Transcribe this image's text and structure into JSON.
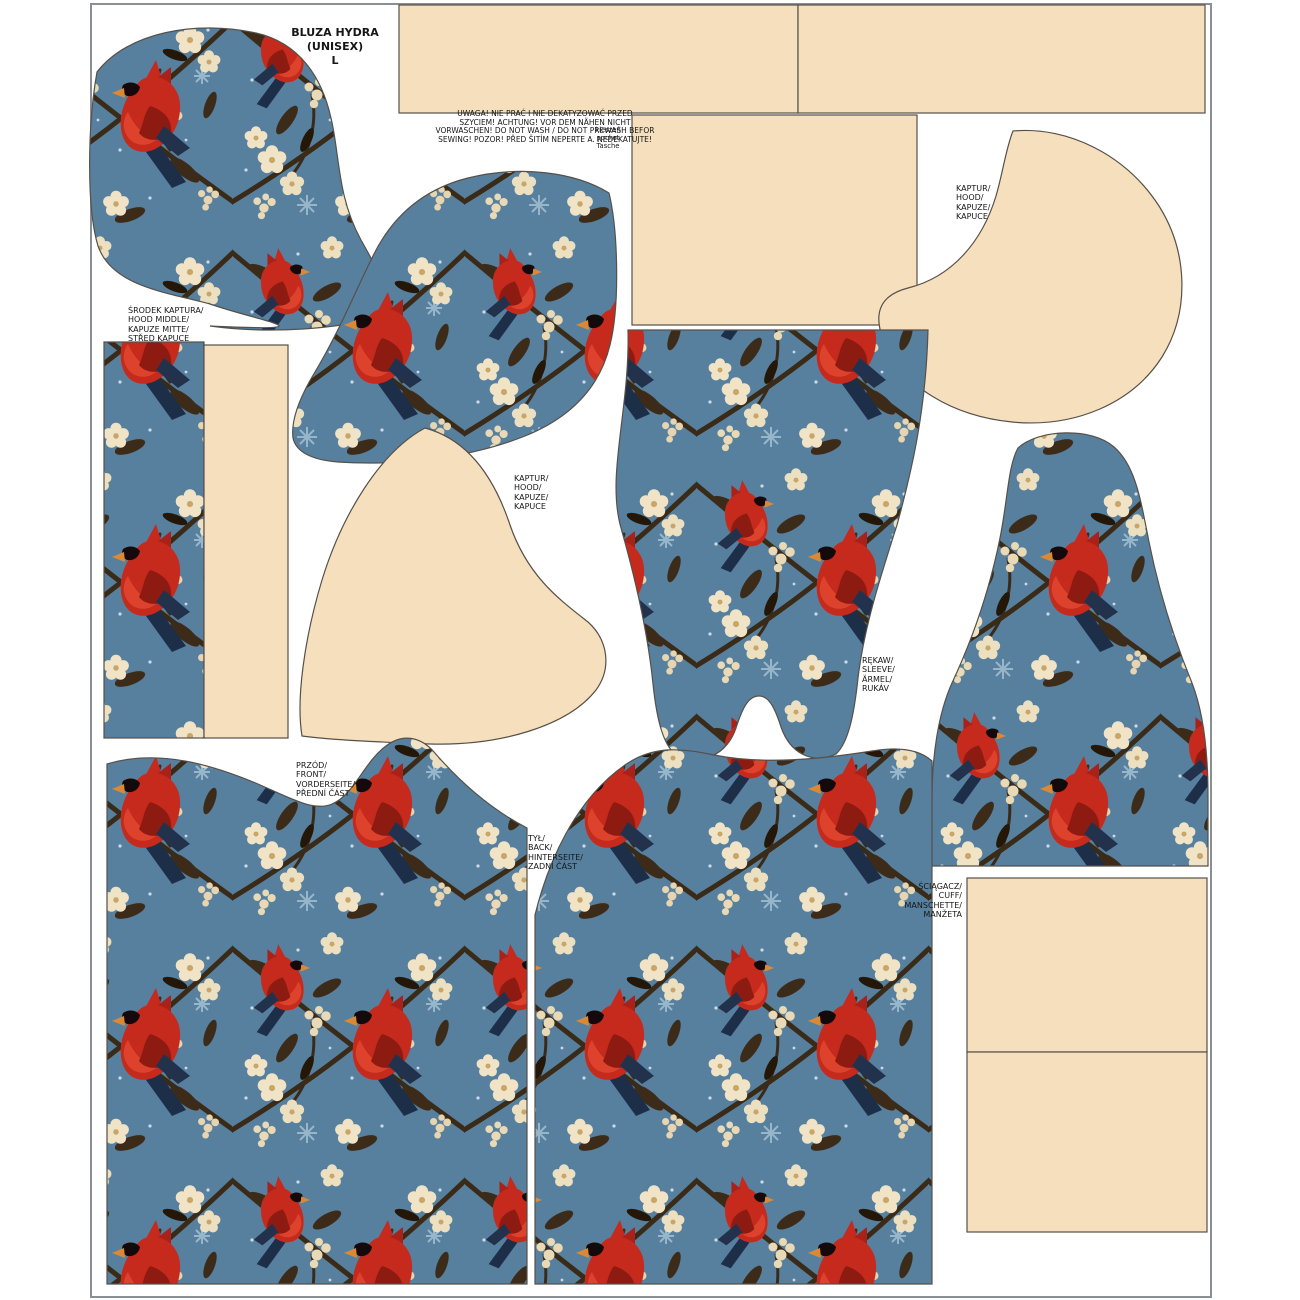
{
  "sheet": {
    "product": {
      "title": "BLUZA HYDRA\n(UNISEX)\nL"
    },
    "warning": "UWAGA! NIE PRAĆ I NIE DEKATYZOWAĆ PRZED\nSZYCIEM! ACHTUNG! VOR DEM NÄHEN NICHT\nVORWASCHEN! DO NOT WASH / DO NOT PREWASH  BEFOR\nSEWING! POZOR! PŘED ŠITÍM NEPERTE A. NEDEKATUJTE!",
    "pocket_note": "kieszeń\npocket\nTasche",
    "labels": {
      "hood_middle": "ŚRODEK KAPTURA/\nHOOD MIDDLE/\nKAPUZE MITTE/\nSTŘED KAPUCE",
      "hood_center": "KAPTUR/\nHOOD/\nKAPUZE/\nKAPUCE",
      "hood_right": "KAPTUR/\nHOOD/\nKAPUZE/\nKAPUCE",
      "sleeve": "RĘKAW/\nSLEEVE/\nÄRMEL/\nRUKÁV",
      "front": "PRZÓD/\nFRONT/\nVORDERSEITE/\nPŘEDNÍ ČÁST",
      "back": "TYŁ/\nBACK/\nHINTERSEITE/\nZADNÍ ČÁST",
      "cuff": "ŚCIĄGACZ/\nCUFF/\nMANSCHETTE/\nMANŽETA"
    },
    "colors": {
      "fabric_blue": "#57809f",
      "blank_beige": "#f6dfbc",
      "cardinal_red": "#c52a1d",
      "cardinal_dark_red": "#8e1b12",
      "blossom_cream": "#f0e3c6",
      "branch_brown": "#3a2a18",
      "wing_navy": "#1d2e49",
      "piece_outline": "#56504a",
      "sheet_border_gray": "#8a8f93"
    },
    "pieces": [
      {
        "name": "hood-piece-print-left",
        "fill": "print"
      },
      {
        "name": "hood-piece-print-center",
        "fill": "print"
      },
      {
        "name": "hood-piece-blank-center",
        "fill": "plain"
      },
      {
        "name": "hood-piece-blank-right",
        "fill": "plain"
      },
      {
        "name": "waistband-strip-left",
        "fill": "plain"
      },
      {
        "name": "waistband-strip-right",
        "fill": "plain"
      },
      {
        "name": "pocket-panel",
        "fill": "plain"
      },
      {
        "name": "hood-middle-strip-print",
        "fill": "print"
      },
      {
        "name": "hood-middle-strip-blank",
        "fill": "plain"
      },
      {
        "name": "sleeve-piece-print-center",
        "fill": "print"
      },
      {
        "name": "sleeve-piece-print-right",
        "fill": "print"
      },
      {
        "name": "front-piece",
        "fill": "print"
      },
      {
        "name": "back-piece",
        "fill": "print"
      },
      {
        "name": "cuff-panel-top",
        "fill": "plain"
      },
      {
        "name": "cuff-panel-bottom",
        "fill": "plain"
      }
    ]
  }
}
